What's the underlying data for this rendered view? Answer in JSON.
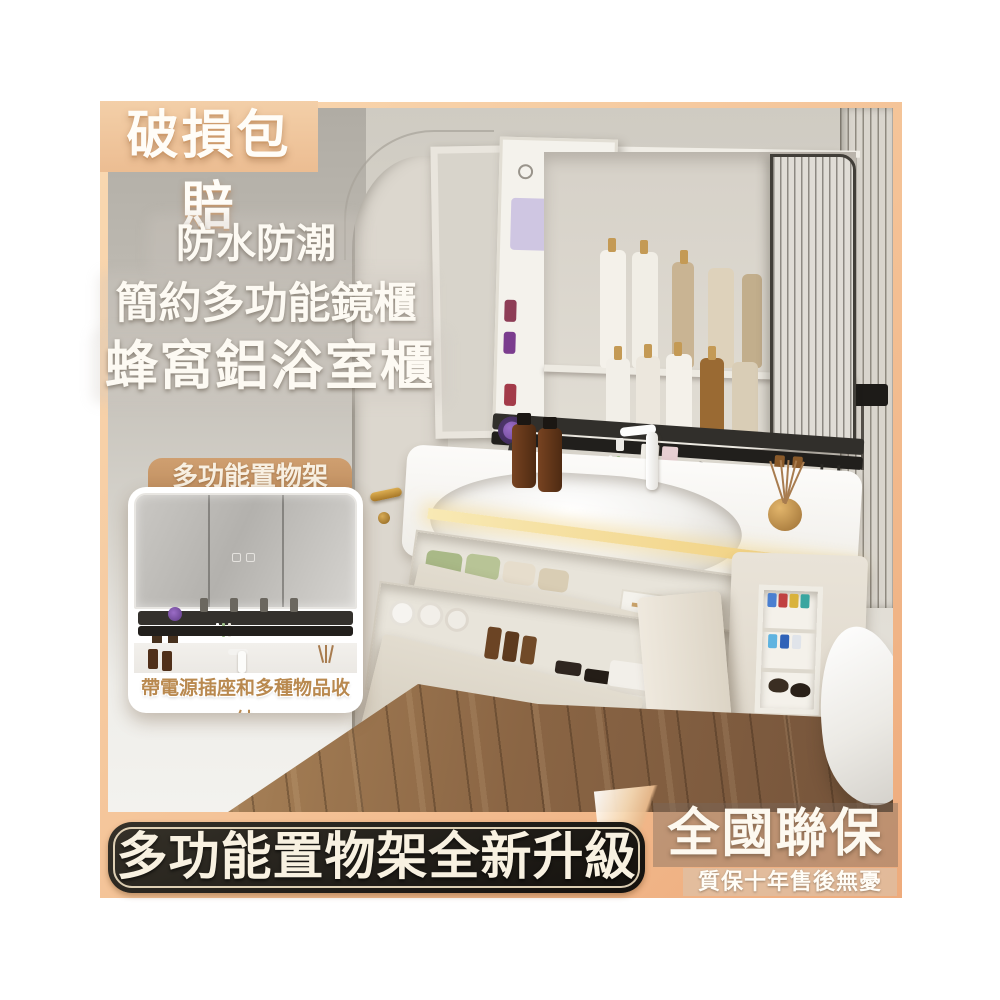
{
  "badges": {
    "damage": "破損包賠",
    "warranty_title": "全國聯保",
    "warranty_sub": "質保十年售後無憂"
  },
  "headline": {
    "line1": "防水防潮",
    "line2": "簡約多功能鏡櫃",
    "line3": "蜂窩鋁浴室櫃"
  },
  "inset": {
    "label": "多功能置物架",
    "caption": "帶電源插座和多種物品收納"
  },
  "banner": {
    "text": "多功能置物架全新升級"
  },
  "palette": {
    "frame_peach_light": "#f9d9b2",
    "frame_peach_dark": "#eeab7c",
    "damage_badge_bg": "#f0c79e",
    "banner_bg": "#211e19",
    "banner_outline": "#f2e2c4",
    "banner_text": "#f8f1e1",
    "inset_label_bg": "#c79a6c",
    "inset_caption_text": "#b9894f",
    "overlay_text": "#fdfaf3",
    "led_strip": "#f0cc78",
    "hairdryer_purple": "#5f3b85",
    "wood_floor": "#8a6544"
  }
}
